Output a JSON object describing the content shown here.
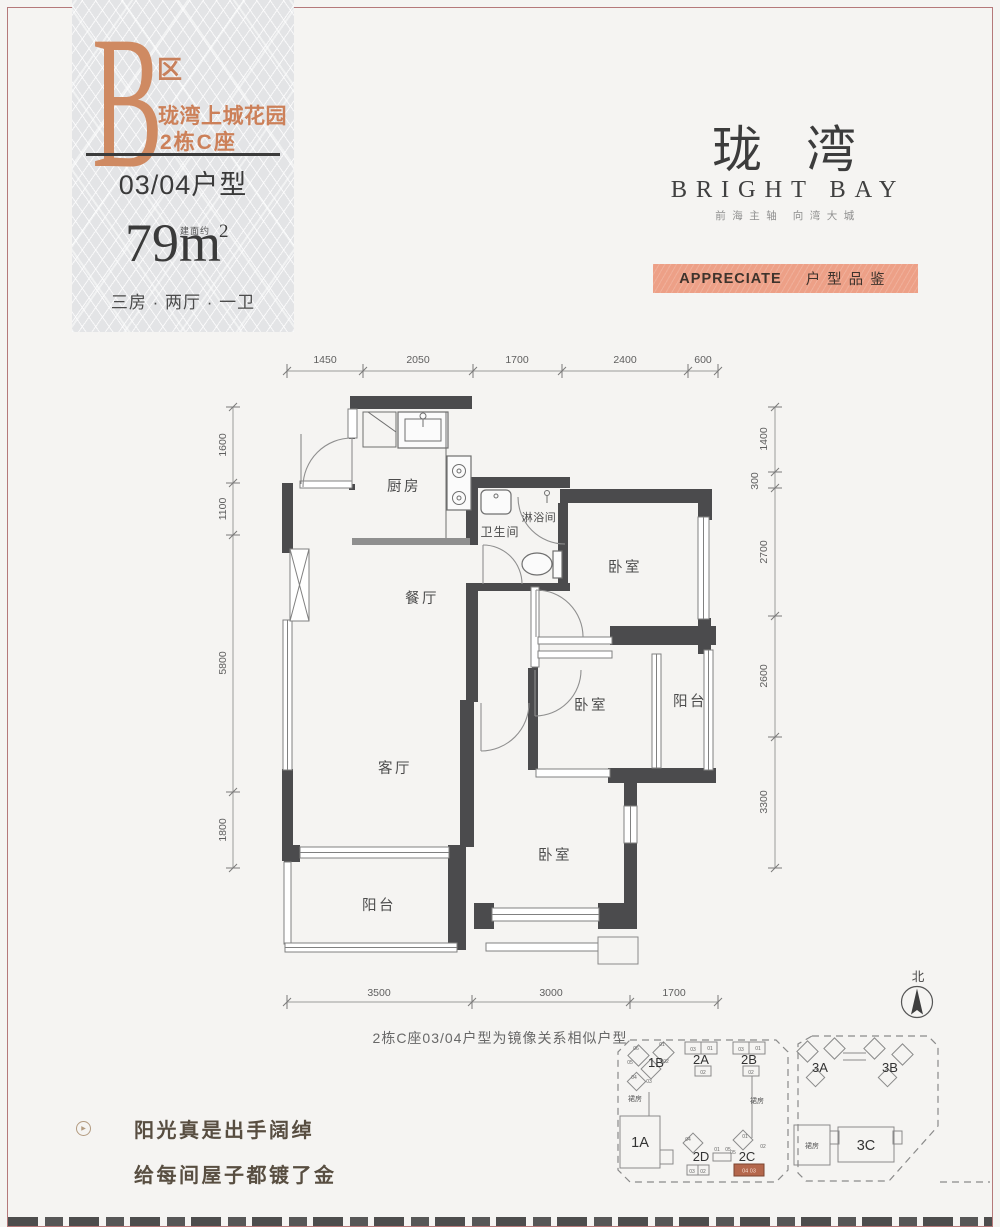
{
  "badge": {
    "zone_letter": "B",
    "zone_suffix": "区",
    "project_name": "珑湾上城花园",
    "building": "2栋C座",
    "unit_type": "03/04户型",
    "area_note": "建面约",
    "area_value": "79m",
    "area_sup": "2",
    "layout": "三房 · 两厅 · 一卫"
  },
  "brand": {
    "logo_cn": "珑湾",
    "logo_en": "BRIGHT BAY",
    "tagline": "前海主轴  向湾大城",
    "banner_en": "APPRECIATE",
    "banner_cn": "户型品鉴"
  },
  "plan": {
    "rooms": {
      "kitchen": "厨房",
      "bath": "卫生间",
      "shower": "淋浴间",
      "bedroom": "卧室",
      "dining": "餐厅",
      "balcony": "阳台",
      "living": "客厅"
    },
    "dims_top": [
      "1450",
      "2050",
      "1700",
      "2400",
      "600"
    ],
    "dims_left": [
      "1600",
      "1100",
      "5800",
      "1800"
    ],
    "dims_right": [
      "1400",
      "300",
      "2700",
      "2600",
      "3300"
    ],
    "dims_bottom": [
      "3500",
      "3000",
      "1700"
    ],
    "compass": "北",
    "note": "2栋C座03/04户型为镜像关系相似户型"
  },
  "siteplan": {
    "podium": "裙房",
    "towers": {
      "t1a": "1A",
      "t1b": "1B",
      "t2a": "2A",
      "t2b": "2B",
      "t2c": "2C",
      "t2d": "2D",
      "t3a": "3A",
      "t3b": "3B",
      "t3c": "3C"
    },
    "units_1b": [
      "06",
      "01",
      "05",
      "02",
      "04",
      "03"
    ],
    "units_2a": [
      "03",
      "01",
      "02"
    ],
    "units_2b": [
      "03",
      "01",
      "02"
    ],
    "units_2d": [
      "04",
      "03",
      "02"
    ],
    "units_2c": [
      "01",
      "05",
      "02"
    ],
    "bridge_units": [
      "01",
      "05"
    ],
    "highlight": "04 03"
  },
  "slogan": {
    "line1": "阳光真是出手阔绰",
    "line2": "给每间屋子都镀了金"
  },
  "colors": {
    "accent_orange": "#cf8a62",
    "banner_bg": "#eda087",
    "wall_dark": "#4b4b4d",
    "highlight_orange": "#b4674c",
    "frame_red": "#b5797a"
  }
}
